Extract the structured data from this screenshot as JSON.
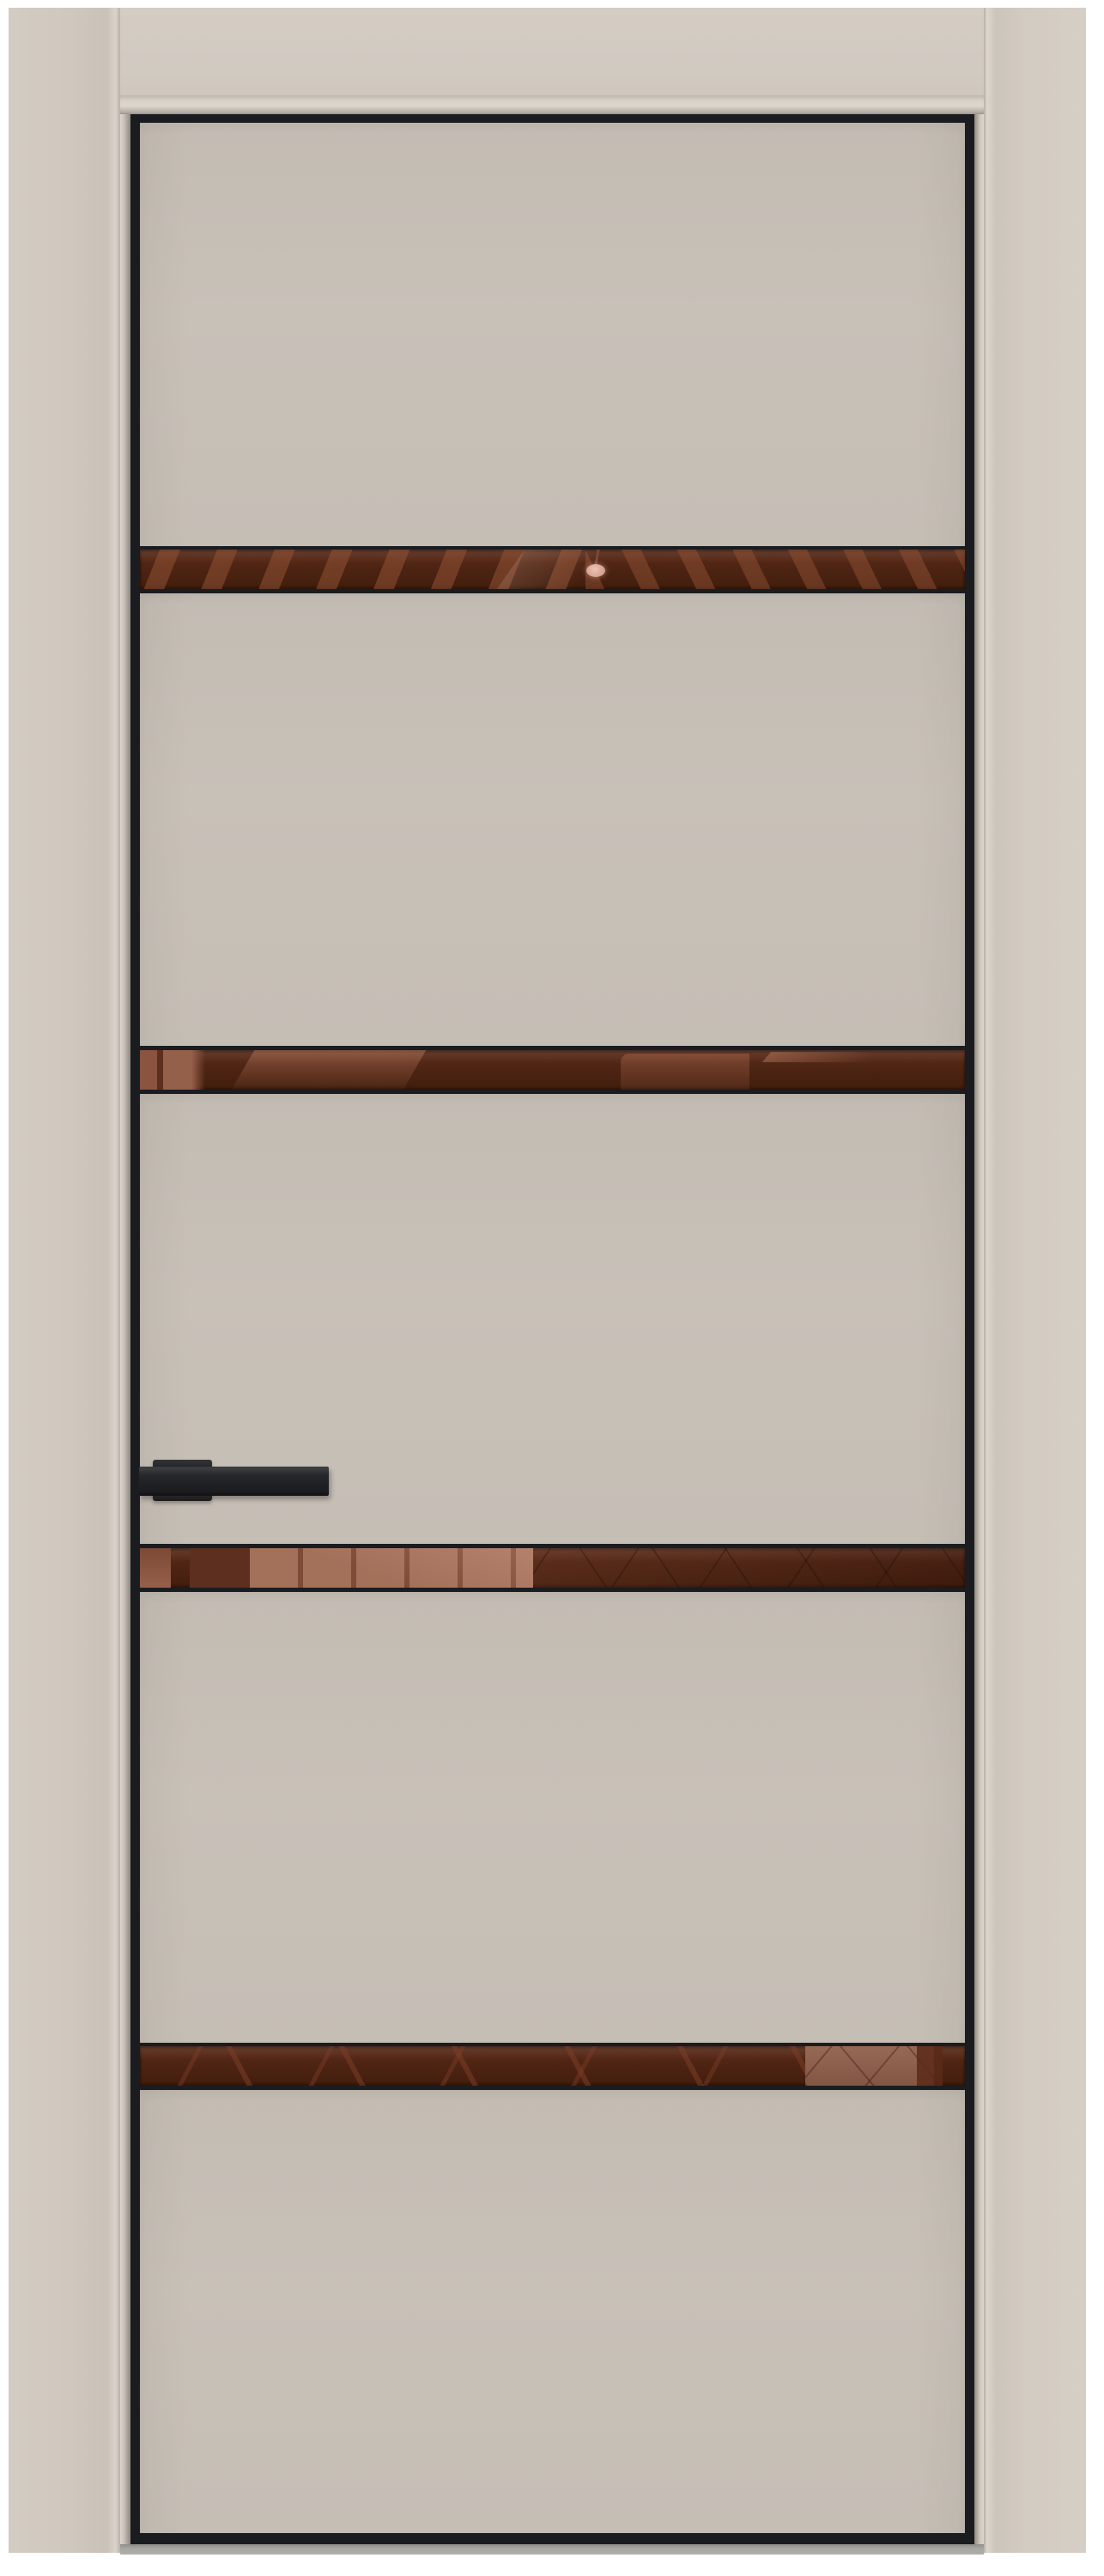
{
  "image": {
    "type": "product-photo",
    "subject": "interior-door-with-bronze-mirror-inserts"
  },
  "door": {
    "panel_count": 5,
    "glass_insert_count": 4,
    "edge_trim": "black-aluminum",
    "handle": {
      "side": "left",
      "type": "rectangular-lever",
      "color": "#202124"
    }
  },
  "glass_inserts": [
    {
      "id": 1,
      "reflection": "ceiling-beams-with-pendant-light"
    },
    {
      "id": 2,
      "reflection": "room-doorway-and-wall"
    },
    {
      "id": 3,
      "reflection": "wood-plank-wall-and-lattice"
    },
    {
      "id": 4,
      "reflection": "diagonal-beams-and-light-block"
    }
  ],
  "colors": {
    "background": "#ffffff",
    "wall": "#d0c9c0",
    "frame_header": "#d0c9c0",
    "reveal_highlight": "#ded7ce",
    "reveal_shadow": "#8f8880",
    "door_panel": "#c8c1b8",
    "door_edge": "#1a1c20",
    "glass_bronze_dark": "#4e2413",
    "glass_beam": "#8a5440",
    "glass_salmon": "#a3705a",
    "handle_black": "#1b1c1f",
    "floor_gray": "#a9a7a4"
  }
}
